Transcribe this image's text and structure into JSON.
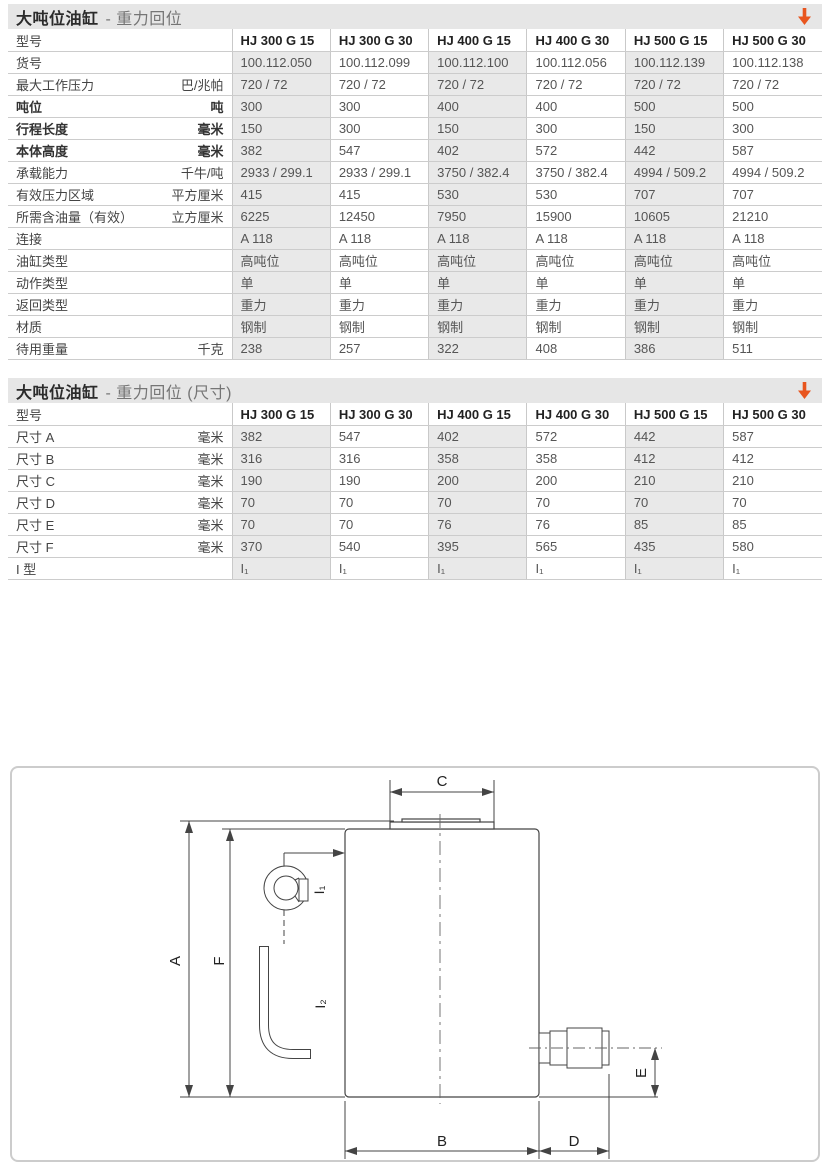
{
  "colors": {
    "accent_orange": "#e8551e",
    "titlebar_bg": "#e6e6e6",
    "cell_shade": "#e9e9e9",
    "table_border": "#cccccc"
  },
  "section1": {
    "title_main": "大吨位油缸",
    "title_sub": "- 重力回位",
    "arrow_icon": "orange-down-arrow",
    "table": {
      "model_header": "型号",
      "columns": [
        "HJ 300 G 15",
        "HJ 300 G 30",
        "HJ 400 G 15",
        "HJ 400 G 30",
        "HJ 500 G 15",
        "HJ 500 G 30"
      ],
      "rows": [
        {
          "label": "货号",
          "unit": "",
          "bold": false,
          "values": [
            "100.112.050",
            "100.112.099",
            "100.112.100",
            "100.112.056",
            "100.112.139",
            "100.112.138"
          ]
        },
        {
          "label": "最大工作压力",
          "unit": "巴/兆帕",
          "bold": false,
          "values": [
            "720 / 72",
            "720 / 72",
            "720 / 72",
            "720 / 72",
            "720 / 72",
            "720 / 72"
          ]
        },
        {
          "label": "吨位",
          "unit": "吨",
          "bold": true,
          "values": [
            "300",
            "300",
            "400",
            "400",
            "500",
            "500"
          ]
        },
        {
          "label": "行程长度",
          "unit": "毫米",
          "bold": true,
          "values": [
            "150",
            "300",
            "150",
            "300",
            "150",
            "300"
          ]
        },
        {
          "label": "本体高度",
          "unit": "毫米",
          "bold": true,
          "values": [
            "382",
            "547",
            "402",
            "572",
            "442",
            "587"
          ]
        },
        {
          "label": "承载能力",
          "unit": "千牛/吨",
          "bold": false,
          "values": [
            "2933 / 299.1",
            "2933 / 299.1",
            "3750 / 382.4",
            "3750 / 382.4",
            "4994 / 509.2",
            "4994 / 509.2"
          ]
        },
        {
          "label": "有效压力区域",
          "unit": "平方厘米",
          "bold": false,
          "values": [
            "415",
            "415",
            "530",
            "530",
            "707",
            "707"
          ]
        },
        {
          "label": "所需含油量（有效）",
          "unit": "立方厘米",
          "bold": false,
          "values": [
            "6225",
            "12450",
            "7950",
            "15900",
            "10605",
            "21210"
          ]
        },
        {
          "label": "连接",
          "unit": "",
          "bold": false,
          "values": [
            "A 118",
            "A 118",
            "A 118",
            "A 118",
            "A 118",
            "A 118"
          ]
        },
        {
          "label": "油缸类型",
          "unit": "",
          "bold": false,
          "values": [
            "高吨位",
            "高吨位",
            "高吨位",
            "高吨位",
            "高吨位",
            "高吨位"
          ]
        },
        {
          "label": "动作类型",
          "unit": "",
          "bold": false,
          "values": [
            "单",
            "单",
            "单",
            "单",
            "单",
            "单"
          ]
        },
        {
          "label": "返回类型",
          "unit": "",
          "bold": false,
          "values": [
            "重力",
            "重力",
            "重力",
            "重力",
            "重力",
            "重力"
          ]
        },
        {
          "label": "材质",
          "unit": "",
          "bold": false,
          "values": [
            "钢制",
            "钢制",
            "钢制",
            "钢制",
            "钢制",
            "钢制"
          ]
        },
        {
          "label": "待用重量",
          "unit": "千克",
          "bold": false,
          "values": [
            "238",
            "257",
            "322",
            "408",
            "386",
            "511"
          ]
        }
      ]
    }
  },
  "section2": {
    "title_main": "大吨位油缸",
    "title_sub": "- 重力回位 (尺寸)",
    "arrow_icon": "orange-down-arrow",
    "table": {
      "model_header": "型号",
      "columns": [
        "HJ 300 G 15",
        "HJ 300 G 30",
        "HJ 400 G 15",
        "HJ 400 G 30",
        "HJ 500 G 15",
        "HJ 500 G 30"
      ],
      "rows": [
        {
          "label": "尺寸 A",
          "unit": "毫米",
          "bold": false,
          "values": [
            "382",
            "547",
            "402",
            "572",
            "442",
            "587"
          ]
        },
        {
          "label": "尺寸 B",
          "unit": "毫米",
          "bold": false,
          "values": [
            "316",
            "316",
            "358",
            "358",
            "412",
            "412"
          ]
        },
        {
          "label": "尺寸 C",
          "unit": "毫米",
          "bold": false,
          "values": [
            "190",
            "190",
            "200",
            "200",
            "210",
            "210"
          ]
        },
        {
          "label": "尺寸 D",
          "unit": "毫米",
          "bold": false,
          "values": [
            "70",
            "70",
            "70",
            "70",
            "70",
            "70"
          ]
        },
        {
          "label": "尺寸 E",
          "unit": "毫米",
          "bold": false,
          "values": [
            "70",
            "70",
            "76",
            "76",
            "85",
            "85"
          ]
        },
        {
          "label": "尺寸 F",
          "unit": "毫米",
          "bold": false,
          "values": [
            "370",
            "540",
            "395",
            "565",
            "435",
            "580"
          ]
        },
        {
          "label": "I 型",
          "unit": "",
          "bold": false,
          "values": [
            "I₁",
            "I₁",
            "I₁",
            "I₁",
            "I₁",
            "I₁"
          ]
        }
      ]
    }
  },
  "diagram": {
    "labels": {
      "A": "A",
      "B": "B",
      "C": "C",
      "D": "D",
      "E": "E",
      "F": "F",
      "i1": "I₁",
      "i2": "I₂"
    }
  }
}
